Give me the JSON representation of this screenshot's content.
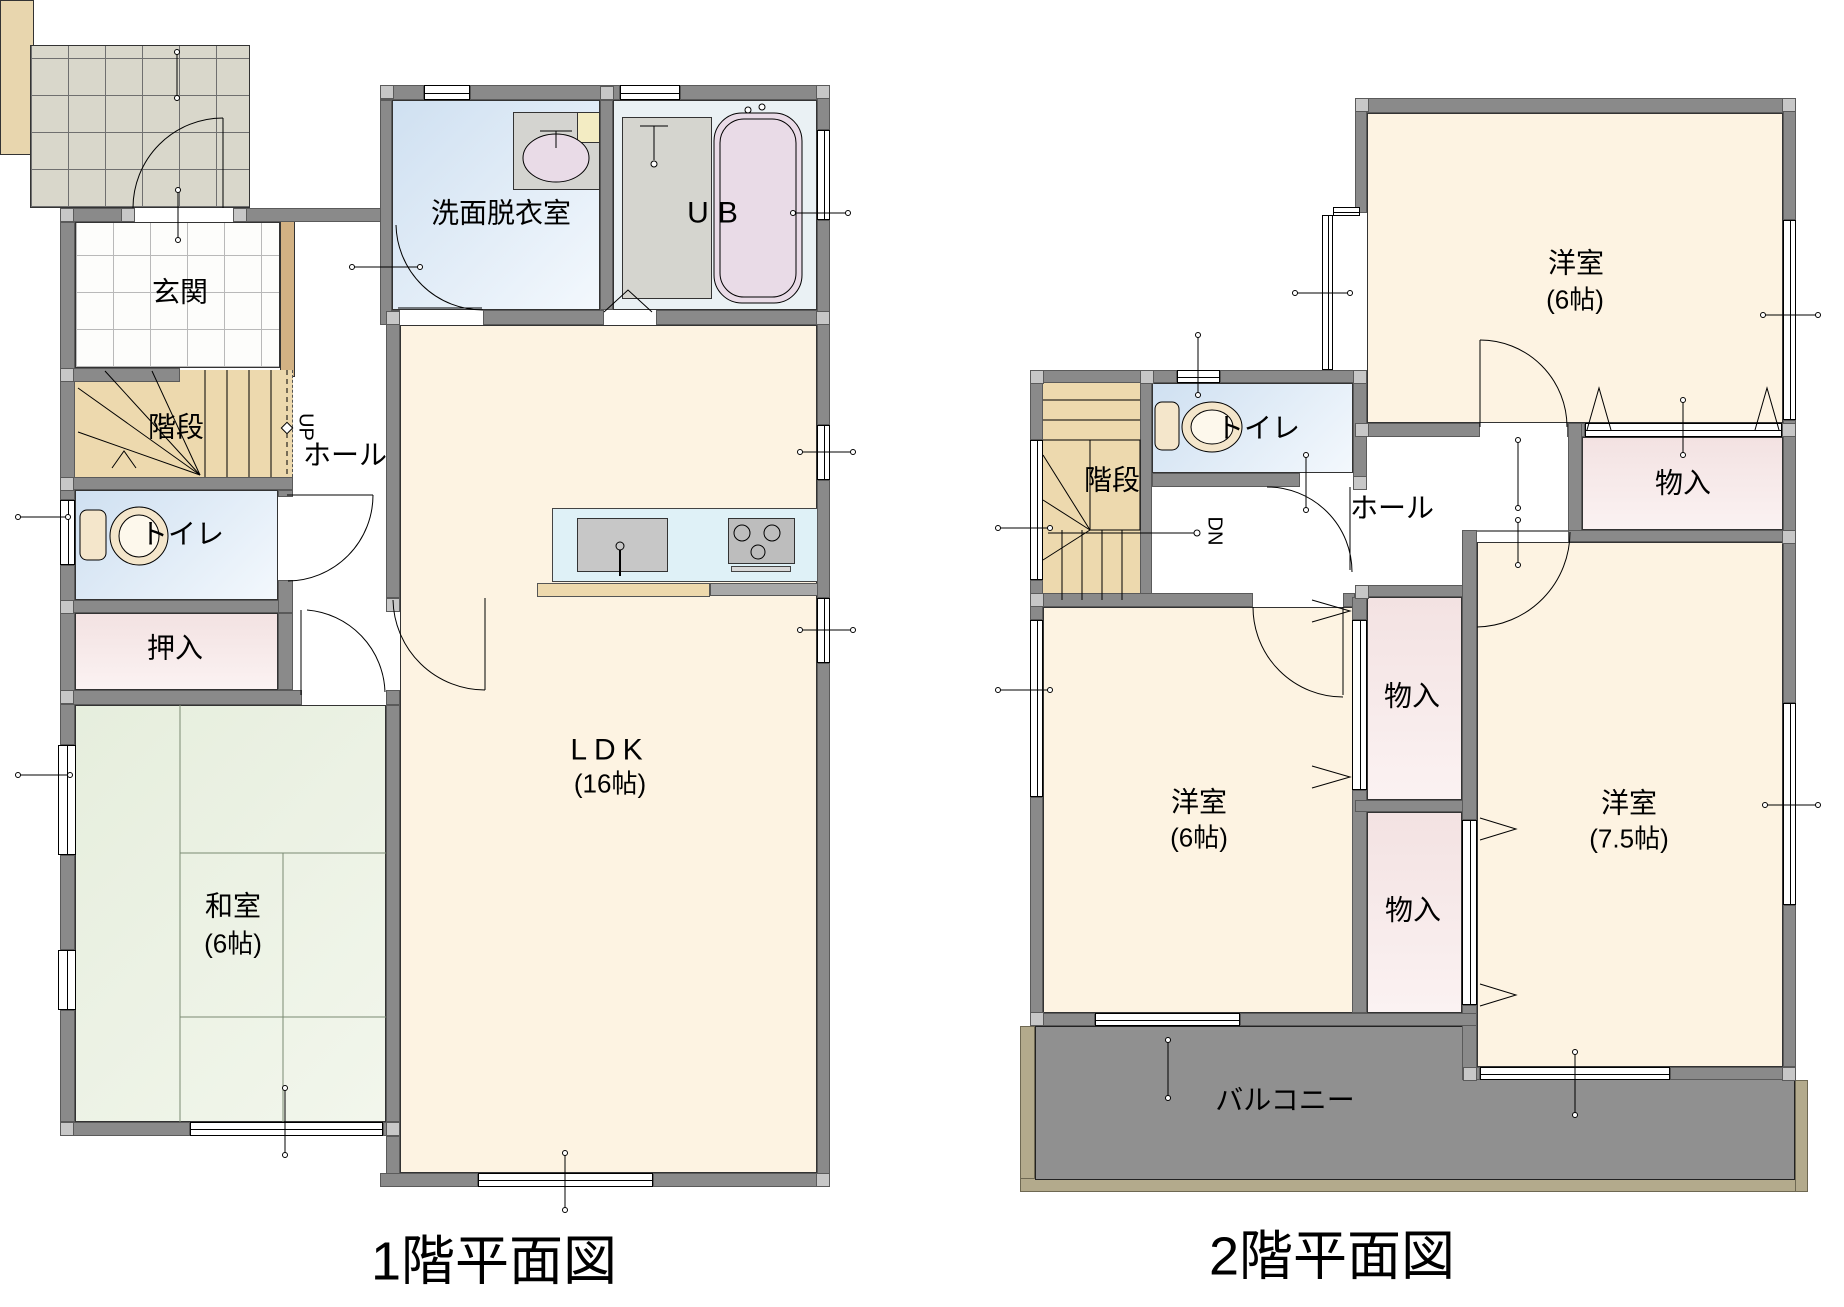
{
  "floor1": {
    "title": "1階平面図",
    "rooms": {
      "genkan": "玄関",
      "senmen": "洗面脱衣室",
      "ub": "UB",
      "kaidan": "階段",
      "up": "UP",
      "hall": "ホール",
      "toilet": "トイレ",
      "oshiire": "押入",
      "washitsu": "和室",
      "washitsu_size": "(6帖)",
      "ldk": "LDK",
      "ldk_size": "(16帖)"
    }
  },
  "floor2": {
    "title": "2階平面図",
    "rooms": {
      "kaidan": "階段",
      "dn": "DN",
      "toilet": "トイレ",
      "hall": "ホール",
      "yoshitsu": "洋室",
      "size_6": "(6帖)",
      "size_75": "(7.5帖)",
      "monoire": "物入",
      "balcony": "バルコニー"
    }
  },
  "colors": {
    "wall": "#8a8a8a",
    "wall_joint": "#c7c7c7",
    "room_cream": "#fdf3e2",
    "tatami_green": "#e9efe1",
    "wet_blue": "#dce8f5",
    "closet_pink": "#f3e2e2",
    "stair_tan": "#edd9ae",
    "balcony_gray": "#909090",
    "balcony_edge": "#b3aa8c",
    "porch_tile": "#d9d7cb",
    "cabinet_tan": "#d2b183",
    "kitchen_counter": "#dff1f7",
    "fixture_pink": "#e9dbe7",
    "fixture_cream": "#f4e6cb"
  }
}
